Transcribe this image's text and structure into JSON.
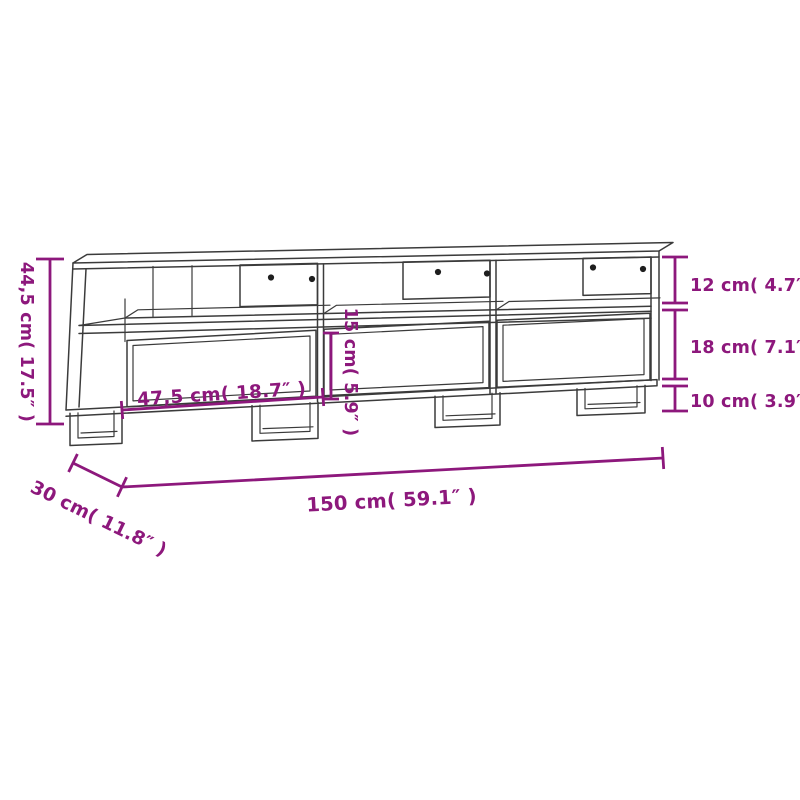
{
  "page": {
    "description": "Product dimension diagram of a TV cabinet with three open compartments and three drawers, drawn as a black line sketch with magenta measurement annotations on a white background"
  },
  "colors": {
    "dimension_accent": "#8d187c",
    "outline_ink": "#3b3b3b",
    "background": "#ffffff"
  },
  "dimension_labels": {
    "overall_height": "44,5 cm( 17.5″ )",
    "top_compartment_height": "12 cm( 4.7″ )",
    "drawer_front_height": "18 cm( 7.1″ )",
    "leg_height": "10 cm( 3.9″ )",
    "drawer_width": "47,5 cm( 18.7″ )",
    "inner_drawer_height": "15 cm( 5.9″ )",
    "overall_width": "150 cm( 59.1″ )",
    "overall_depth": "30 cm( 11.8″ )"
  },
  "measurements": [
    {
      "name": "overall height",
      "cm": 44.5,
      "inch": 17.5
    },
    {
      "name": "top compartment height",
      "cm": 12,
      "inch": 4.7
    },
    {
      "name": "drawer front height",
      "cm": 18,
      "inch": 7.1
    },
    {
      "name": "leg height",
      "cm": 10,
      "inch": 3.9
    },
    {
      "name": "drawer width",
      "cm": 47.5,
      "inch": 18.7
    },
    {
      "name": "inner drawer height",
      "cm": 15,
      "inch": 5.9
    },
    {
      "name": "overall width",
      "cm": 150,
      "inch": 59.1
    },
    {
      "name": "overall depth",
      "cm": 30,
      "inch": 11.8
    }
  ]
}
